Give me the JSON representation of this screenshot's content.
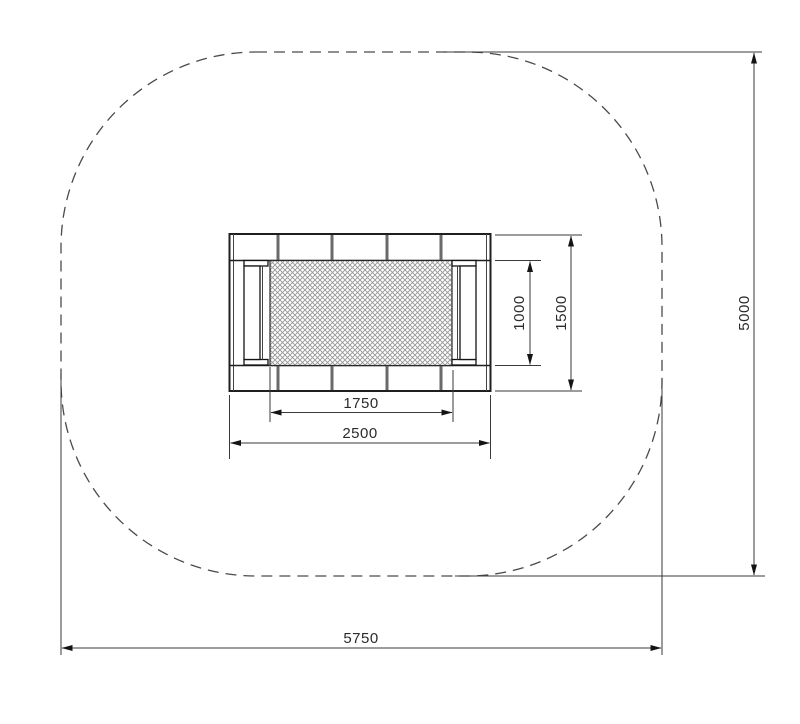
{
  "dimensions": {
    "mat_height": "1000",
    "frame_height": "1500",
    "mat_width": "1750",
    "frame_width": "2500",
    "zone_height": "5000",
    "zone_width": "5750"
  },
  "colors": {
    "background": "#ffffff",
    "line_ink": "#333333",
    "hatch": "#969696",
    "zone_dash": "#4a4a4a"
  }
}
